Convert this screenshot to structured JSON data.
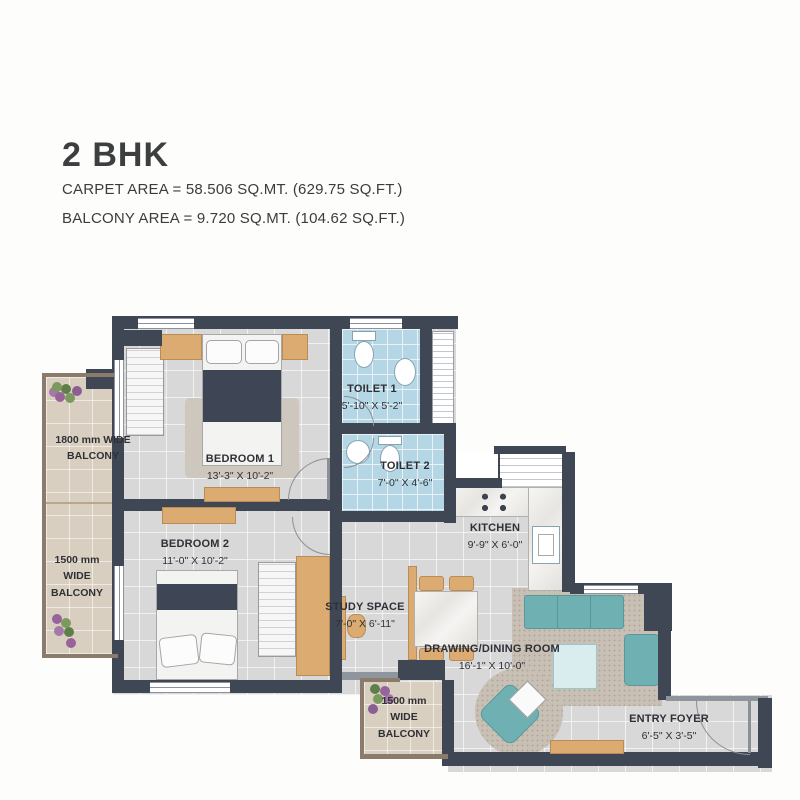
{
  "header": {
    "title": "2 BHK",
    "carpet_area": "CARPET AREA = 58.506 SQ.MT. (629.75 SQ.FT.)",
    "balcony_area": "BALCONY AREA = 9.720 SQ.MT. (104.62 SQ.FT.)"
  },
  "rooms": {
    "bedroom1": {
      "name": "BEDROOM 1",
      "dims": "13'-3\" X 10'-2\""
    },
    "bedroom2": {
      "name": "BEDROOM 2",
      "dims": "11'-0\" X 10'-2\""
    },
    "toilet1": {
      "name": "TOILET 1",
      "dims": "5'-10\" X 5'-2\""
    },
    "toilet2": {
      "name": "TOILET 2",
      "dims": "7'-0\" X 4'-6\""
    },
    "kitchen": {
      "name": "KITCHEN",
      "dims": "9'-9\" X 6'-0\""
    },
    "study": {
      "name": "STUDY SPACE",
      "dims": "7'-0\" X 6'-11\""
    },
    "drawing_dining": {
      "name": "DRAWING/DINING ROOM",
      "dims": "16'-1\" X 10'-0\""
    },
    "entry_foyer": {
      "name": "ENTRY FOYER",
      "dims": "6'-5\" X 3'-5\""
    }
  },
  "balconies": {
    "left_top": {
      "line1": "1800 mm WIDE",
      "line2": "BALCONY"
    },
    "left_bottom": {
      "line1": "1500 mm",
      "line2": "WIDE",
      "line3": "BALCONY"
    },
    "bottom": {
      "line1": "1500 mm",
      "line2": "WIDE",
      "line3": "BALCONY"
    }
  },
  "colors": {
    "wall": "#3f4755",
    "room_floor": "#d8d8d8",
    "toilet_floor": "#b5d7e5",
    "balcony_floor": "#d9cfc1",
    "sofa_teal": "#6fb0b2",
    "furniture_wood": "#dcab72",
    "bed_navy": "#3e4656",
    "text": "#2f3036"
  }
}
